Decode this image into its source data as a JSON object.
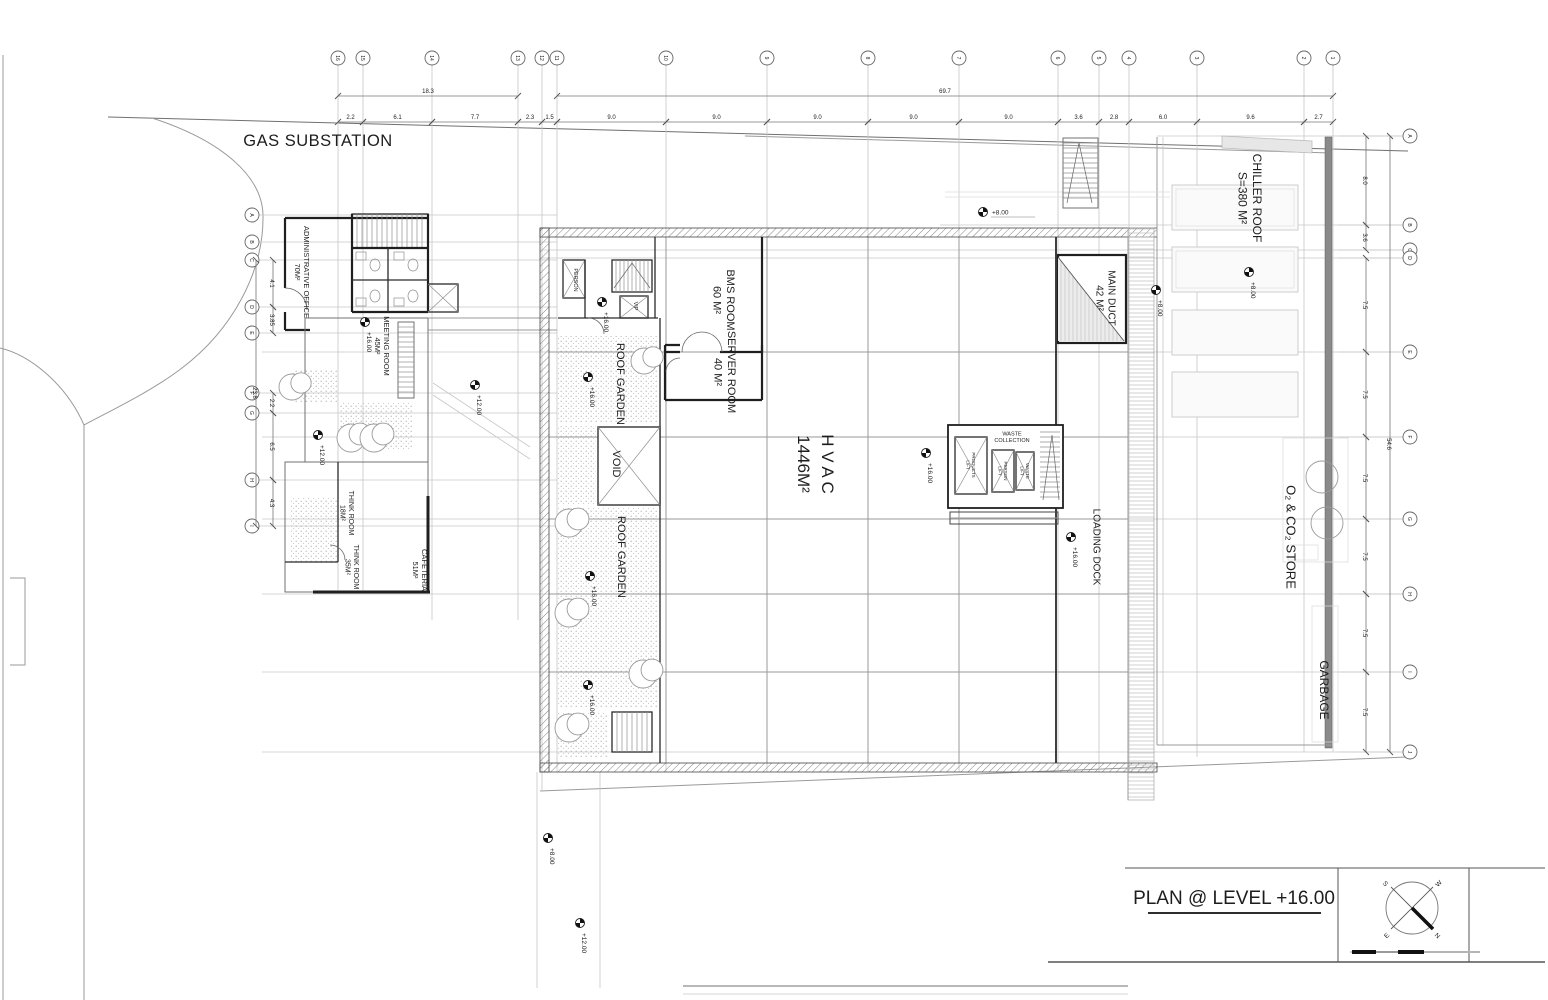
{
  "drawing": {
    "title": "PLAN @ LEVEL +16.00",
    "site_label": "GAS SUBSTATION"
  },
  "compass": {
    "n": "N",
    "s": "S",
    "e": "E",
    "w": "W"
  },
  "colors": {
    "wall": "#1f1f1f",
    "grid": "#c7c7c7",
    "text": "#1d1d1d",
    "muted": "#999999",
    "level_text": "#9a9a9a"
  },
  "grid": {
    "top": {
      "bubbles": [
        {
          "label": "16",
          "x": 338
        },
        {
          "label": "15",
          "x": 363
        },
        {
          "label": "14",
          "x": 432
        },
        {
          "label": "13",
          "x": 518
        },
        {
          "label": "12",
          "x": 542
        },
        {
          "label": "11",
          "x": 557
        },
        {
          "label": "10",
          "x": 666
        },
        {
          "label": "9",
          "x": 767
        },
        {
          "label": "8",
          "x": 868
        },
        {
          "label": "7",
          "x": 959
        },
        {
          "label": "6",
          "x": 1058
        },
        {
          "label": "5",
          "x": 1099
        },
        {
          "label": "4",
          "x": 1129
        },
        {
          "label": "3",
          "x": 1197
        },
        {
          "label": "2",
          "x": 1304
        },
        {
          "label": "1",
          "x": 1333
        }
      ],
      "overalls": [
        {
          "t": "18.3",
          "a": 338,
          "b": 518
        },
        {
          "t": "69.7",
          "a": 557,
          "b": 1333
        }
      ],
      "segments": [
        {
          "t": "2.2",
          "a": 338,
          "b": 363
        },
        {
          "t": "6.1",
          "a": 363,
          "b": 432
        },
        {
          "t": "7.7",
          "a": 432,
          "b": 518
        },
        {
          "t": "2.3",
          "a": 518,
          "b": 542
        },
        {
          "t": "1.5",
          "a": 542,
          "b": 557
        },
        {
          "t": "9.0",
          "a": 557,
          "b": 666
        },
        {
          "t": "9.0",
          "a": 666,
          "b": 767
        },
        {
          "t": "9.0",
          "a": 767,
          "b": 868
        },
        {
          "t": "9.0",
          "a": 868,
          "b": 959
        },
        {
          "t": "9.0",
          "a": 959,
          "b": 1058
        },
        {
          "t": "3.6",
          "a": 1058,
          "b": 1099
        },
        {
          "t": "2.8",
          "a": 1099,
          "b": 1129
        },
        {
          "t": "6.0",
          "a": 1129,
          "b": 1197
        },
        {
          "t": "9.6",
          "a": 1197,
          "b": 1304
        },
        {
          "t": "2.7",
          "a": 1304,
          "b": 1333
        }
      ]
    },
    "left": {
      "bubbles": [
        {
          "label": "A",
          "y": 215
        },
        {
          "label": "B",
          "y": 242
        },
        {
          "label": "C",
          "y": 260
        },
        {
          "label": "D",
          "y": 307
        },
        {
          "label": "E",
          "y": 333
        },
        {
          "label": "F",
          "y": 393
        },
        {
          "label": "G",
          "y": 413
        },
        {
          "label": "H",
          "y": 480
        },
        {
          "label": "I",
          "y": 526
        }
      ],
      "overall": {
        "t": "23.8",
        "a": 260,
        "b": 526
      },
      "segments": [
        {
          "t": "4.1",
          "a": 260,
          "b": 307
        },
        {
          "t": "3.85",
          "a": 307,
          "b": 333
        },
        {
          "t": "2.2",
          "a": 393,
          "b": 413
        },
        {
          "t": "6.5",
          "a": 413,
          "b": 480
        },
        {
          "t": "4.3",
          "a": 480,
          "b": 526
        }
      ]
    },
    "right": {
      "bubbles": [
        {
          "label": "A",
          "y": 136
        },
        {
          "label": "B",
          "y": 225
        },
        {
          "label": "C",
          "y": 250
        },
        {
          "label": "D",
          "y": 258
        },
        {
          "label": "E",
          "y": 352
        },
        {
          "label": "F",
          "y": 437
        },
        {
          "label": "G",
          "y": 519
        },
        {
          "label": "H",
          "y": 594
        },
        {
          "label": "I",
          "y": 672
        },
        {
          "label": "J",
          "y": 752
        }
      ],
      "overall": {
        "t": "54.6",
        "a": 136,
        "b": 752
      },
      "segments": [
        {
          "t": "8.0",
          "a": 136,
          "b": 225
        },
        {
          "t": "3.6",
          "a": 225,
          "b": 250
        },
        {
          "t": "7.5",
          "a": 258,
          "b": 352
        },
        {
          "t": "7.5",
          "a": 352,
          "b": 437
        },
        {
          "t": "7.5",
          "a": 437,
          "b": 519
        },
        {
          "t": "7.5",
          "a": 519,
          "b": 594
        },
        {
          "t": "7.5",
          "a": 594,
          "b": 672
        },
        {
          "t": "7.5",
          "a": 672,
          "b": 752
        }
      ]
    }
  },
  "labels": [
    {
      "name": "gas-substation-label",
      "lines": [
        "GAS SUBSTATION"
      ],
      "x": 318,
      "y": 140,
      "rot": 0,
      "size": 16.5,
      "ls": 0.5
    },
    {
      "name": "administrative-office-label",
      "lines": [
        "ADMINISTRATIVE OFFICE",
        "70M²"
      ],
      "x": 302,
      "y": 272,
      "rot": 90,
      "size": 7.5
    },
    {
      "name": "meeting-room-label",
      "lines": [
        "MEETING ROOM",
        "45M²"
      ],
      "x": 382,
      "y": 346,
      "rot": 90,
      "size": 7.5
    },
    {
      "name": "think-room-18-label",
      "lines": [
        "THINK ROOM",
        "18M²"
      ],
      "x": 347,
      "y": 513,
      "rot": 90,
      "size": 7
    },
    {
      "name": "think-room-35-label",
      "lines": [
        "THINK ROOM",
        "35M²"
      ],
      "x": 352,
      "y": 567,
      "rot": 90,
      "size": 7
    },
    {
      "name": "cafeteria-label",
      "lines": [
        "CAFETERIA",
        "51M²"
      ],
      "x": 420,
      "y": 570,
      "rot": 90,
      "size": 7.5
    },
    {
      "name": "person-lift-label",
      "lines": [
        "PERSON"
      ],
      "x": 576,
      "y": 280,
      "rot": 90,
      "size": 5.5
    },
    {
      "name": "vip-lift-label",
      "lines": [
        "VIP"
      ],
      "x": 636,
      "y": 306,
      "rot": 90,
      "size": 5.5
    },
    {
      "name": "bms-room-label",
      "lines": [
        "BMS ROOM",
        "60 M²"
      ],
      "x": 724,
      "y": 300,
      "rot": 90,
      "size": 11
    },
    {
      "name": "server-room-label",
      "lines": [
        "SERVER ROOM",
        "40 M²"
      ],
      "x": 725,
      "y": 372,
      "rot": 90,
      "size": 11
    },
    {
      "name": "roof-garden-upper-label",
      "lines": [
        "ROOF GARDEN"
      ],
      "x": 621,
      "y": 384,
      "rot": 90,
      "size": 11
    },
    {
      "name": "void-label",
      "lines": [
        "VOID"
      ],
      "x": 617,
      "y": 464,
      "rot": 90,
      "size": 11
    },
    {
      "name": "roof-garden-lower-label",
      "lines": [
        "ROOF GARDEN"
      ],
      "x": 622,
      "y": 557,
      "rot": 90,
      "size": 11
    },
    {
      "name": "hvac-label",
      "lines": [
        "H V A C",
        "1446M²"
      ],
      "x": 816,
      "y": 464,
      "rot": 90,
      "size": 17,
      "gap": 24
    },
    {
      "name": "waste-collection-label",
      "lines": [
        "WASTE",
        "COLLECTION"
      ],
      "x": 1012,
      "y": 437,
      "rot": 0,
      "size": 5.5
    },
    {
      "name": "products-lift-label",
      "lines": [
        "PRODUCTS",
        "LIFT"
      ],
      "x": 971,
      "y": 465,
      "rot": 90,
      "size": 4.5
    },
    {
      "name": "person-lift2-label",
      "lines": [
        "PERSON",
        "LIFT"
      ],
      "x": 1003,
      "y": 471,
      "rot": 90,
      "size": 4.5
    },
    {
      "name": "waste-lift-label",
      "lines": [
        "WASTE",
        "LIFT"
      ],
      "x": 1025,
      "y": 471,
      "rot": 90,
      "size": 4.5
    },
    {
      "name": "main-duct-label",
      "lines": [
        "MAIN DUCT",
        "42 M²"
      ],
      "x": 1106,
      "y": 298,
      "rot": 90,
      "size": 10
    },
    {
      "name": "chiller-roof-label",
      "lines": [
        "CHILLER ROOF",
        "S=380 M²"
      ],
      "x": 1250,
      "y": 198,
      "rot": 90,
      "size": 12
    },
    {
      "name": "loading-dock-label",
      "lines": [
        "LOADING DOCK"
      ],
      "x": 1097,
      "y": 547,
      "rot": 90,
      "size": 10
    },
    {
      "name": "o2-co2-store-label",
      "lines": [
        "O₂ & CO₂ STORE"
      ],
      "x": 1291,
      "y": 537,
      "rot": 90,
      "size": 13
    },
    {
      "name": "garbage-label",
      "lines": [
        "GARBAGE"
      ],
      "x": 1324,
      "y": 690,
      "rot": 90,
      "size": 12
    }
  ],
  "level_markers": [
    {
      "label": "+16.00",
      "x": 365,
      "y": 322,
      "dir": "v"
    },
    {
      "label": "+12.00",
      "x": 318,
      "y": 435,
      "dir": "v"
    },
    {
      "label": "+12.00",
      "x": 475,
      "y": 385,
      "dir": "v"
    },
    {
      "label": "+16.00",
      "x": 602,
      "y": 302,
      "dir": "v"
    },
    {
      "label": "+16.00",
      "x": 588,
      "y": 377,
      "dir": "v"
    },
    {
      "label": "+16.00",
      "x": 590,
      "y": 576,
      "dir": "v"
    },
    {
      "label": "+16.00",
      "x": 588,
      "y": 685,
      "dir": "v"
    },
    {
      "label": "+16.00",
      "x": 926,
      "y": 453,
      "dir": "v"
    },
    {
      "label": "+16.00",
      "x": 1071,
      "y": 537,
      "dir": "v"
    },
    {
      "label": "+8.00",
      "x": 983,
      "y": 212,
      "dir": "h"
    },
    {
      "label": "+8.00",
      "x": 1156,
      "y": 290,
      "dir": "v"
    },
    {
      "label": "+8.00",
      "x": 1249,
      "y": 272,
      "dir": "v"
    },
    {
      "label": "+8.00",
      "x": 548,
      "y": 838,
      "dir": "v"
    },
    {
      "label": "+12.00",
      "x": 580,
      "y": 923,
      "dir": "v"
    }
  ],
  "trees": [
    {
      "x": 296,
      "y": 386,
      "r": 13
    },
    {
      "x": 355,
      "y": 437,
      "r": 14
    },
    {
      "x": 378,
      "y": 437,
      "r": 14
    },
    {
      "x": 648,
      "y": 360,
      "r": 13
    },
    {
      "x": 573,
      "y": 522,
      "r": 14
    },
    {
      "x": 573,
      "y": 612,
      "r": 14
    },
    {
      "x": 647,
      "y": 673,
      "r": 14
    },
    {
      "x": 573,
      "y": 727,
      "r": 14
    }
  ]
}
